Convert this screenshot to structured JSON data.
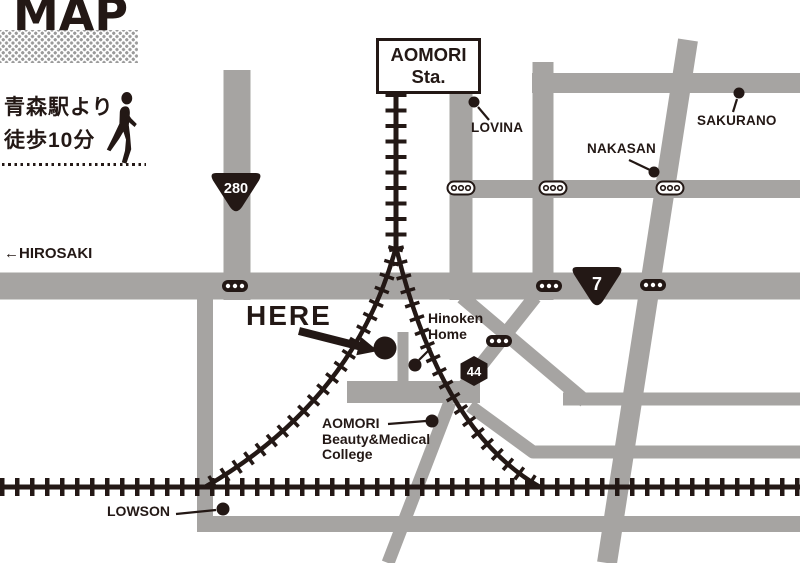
{
  "title": "MAP",
  "access_note": {
    "line1": "青森駅より",
    "line2": "徒歩10分"
  },
  "station": {
    "name_line1": "AOMORI",
    "name_line2": "Sta."
  },
  "labels": {
    "hirosaki": "←HIROSAKI",
    "here": "HERE",
    "lovina": "LOVINA",
    "nakasan": "NAKASAN",
    "sakurano": "SAKURANO",
    "hinoken_line1": "Hinoken",
    "hinoken_line2": "Home",
    "college_line1": "AOMORI",
    "college_line2": "Beauty&Medical",
    "college_line3": "College",
    "lowson": "LOWSON"
  },
  "route_badges": {
    "national_280": "280",
    "national_7": "7",
    "prefectural_44": "44"
  },
  "colors": {
    "ink": "#231815",
    "road": "#a6a4a2",
    "background": "#ffffff",
    "halftone_dot": "#9a9a9a"
  }
}
